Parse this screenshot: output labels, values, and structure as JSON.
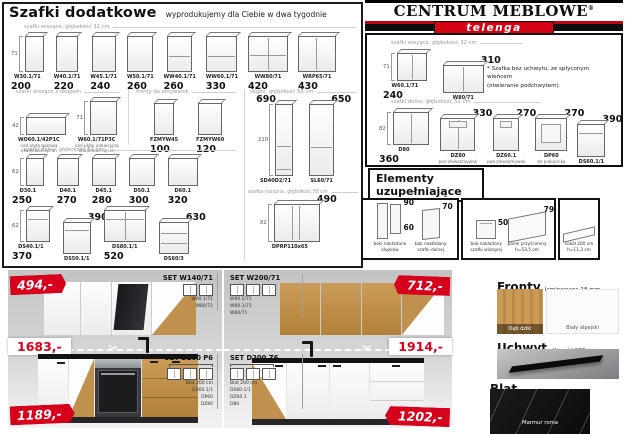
{
  "accent": {
    "red": "#d6001c",
    "wood": "#c0914e"
  },
  "header": {
    "title": "Szafki dodatkowe",
    "subtitle": "wyprodukujemy dla Ciebie w dwa tygodnie"
  },
  "logo": {
    "name": "CENTRUM MEBLOWE",
    "reg": "®",
    "sub": "telenga"
  },
  "catalog_left": {
    "row_wiszace": {
      "label": "szafki wiszące, głębokość 32 cm",
      "dim": "71",
      "items": [
        {
          "code": "W30.1/71",
          "price": "200",
          "pp": "bl"
        },
        {
          "code": "W40.1/71",
          "price": "220",
          "pp": "bl"
        },
        {
          "code": "W45.1/71",
          "price": "240",
          "pp": "bl"
        },
        {
          "code": "W50.1/71",
          "price": "260",
          "pp": "bl"
        },
        {
          "code": "WW40.1/71",
          "price": "260",
          "pp": "bl"
        },
        {
          "code": "WW60.1/71",
          "price": "330",
          "pp": "bl"
        },
        {
          "code": "WW80/71",
          "price": "420",
          "pp": "bl"
        },
        {
          "code": "WRP65/71",
          "price": "430",
          "pp": "bl"
        }
      ]
    },
    "row_okap": {
      "label": "szafki wiszące z okapem",
      "items": [
        {
          "code": "WO60.1/42P1C",
          "dim": "42",
          "sub": [
            "nad płytę gazową",
            "otwieranie tip-on"
          ]
        },
        {
          "code": "W60.1/71P3C",
          "dim": "71",
          "sub": [
            "nad płytę indukcyjną",
            "otwieranie tip-on"
          ]
        }
      ]
    },
    "row_fronty": {
      "label": "fronty do zmywarek",
      "items": [
        {
          "code": "FZMYW45",
          "price": "100",
          "pp": "bl"
        },
        {
          "code": "FZMYW60",
          "price": "120",
          "pp": "bl"
        }
      ]
    },
    "col_slupki": {
      "label": "słupki, głębokość 58 cm",
      "dim": "210",
      "items": [
        {
          "code": "SD40D2/71",
          "price": "690",
          "pp": "tl"
        },
        {
          "code": "SL60/71",
          "price": "650",
          "pp": "tr"
        }
      ]
    },
    "row_dolne_label": "szafki dolne, głębokość 51 cm",
    "row_dolneA": {
      "dim": "62",
      "items": [
        {
          "code": "D30.1",
          "price": "250",
          "pp": "bl"
        },
        {
          "code": "D40.1",
          "price": "270",
          "pp": "bl"
        },
        {
          "code": "D45.1",
          "price": "280",
          "pp": "bl"
        },
        {
          "code": "D50.1",
          "price": "300",
          "pp": "bl"
        },
        {
          "code": "D60.1",
          "price": "320",
          "pp": "bl"
        }
      ]
    },
    "row_dolneB": {
      "dim": "62",
      "items": [
        {
          "code": "DS40.1/1",
          "price": "370",
          "pp": "bl"
        },
        {
          "code": "DS50.1/1",
          "price": "390",
          "pp": "tr"
        },
        {
          "code": "DS80.1/1",
          "price": "520",
          "pp": "bl"
        },
        {
          "code": "DS60/3",
          "price": "630",
          "pp": "tr"
        }
      ]
    },
    "row_narozna": {
      "label": "szafka narożna, głębokość 58 cm",
      "dim": "82",
      "items": [
        {
          "code": "DPRP110x65",
          "price": "490",
          "pp": "tr"
        }
      ]
    }
  },
  "catalog_right": {
    "wiszace": {
      "label": "szafki wiszące, głębokość 32 cm",
      "dim": "71",
      "items": [
        {
          "code": "W60.1/71",
          "price": "240",
          "pp": "bl"
        },
        {
          "code": "W80/71",
          "price": "310",
          "pp": "tr"
        }
      ]
    },
    "note": "* Szafka bez uchwytu, ze spłyconym wieńcem\n(otwieranie podchwytem).",
    "dolne": {
      "label": "szafki dolne, głębokość 51 cm",
      "dim": "82",
      "items": [
        {
          "code": "D80",
          "price": "360",
          "pp": "bl"
        },
        {
          "code": "DZ80",
          "price": "330",
          "pp": "tr",
          "sub": [
            "pod zlewozmywak"
          ]
        },
        {
          "code": "DZ60.1",
          "price": "270",
          "pp": "tr",
          "sub": [
            "pod zlewozmywak"
          ]
        },
        {
          "code": "DP60",
          "price": "270",
          "pp": "tr",
          "sub": [
            "do piekarnika"
          ]
        },
        {
          "code": "DS60.1/1",
          "price": "390",
          "pp": "tr"
        }
      ]
    }
  },
  "elements": {
    "title": "Elementy\nuzupełniające",
    "box1": [
      {
        "label": "boki nakładane\nsłupków",
        "price_top": "90",
        "price_bottom": "60"
      },
      {
        "label": "bok nakładany\nszafki dolnej",
        "price": "70"
      }
    ],
    "box2": [
      {
        "label": "bok nakładany\nszafki wiszącej",
        "price": "50"
      },
      {
        "label": "panel przyścienny\nh=53,5 cm",
        "price": "79"
      }
    ],
    "box3": [
      {
        "label": "cokół 200 cm\nh=11,3 cm"
      }
    ]
  },
  "sets": {
    "photo1": {
      "badge_top": "494,-",
      "set_top": {
        "name": "SET W140/71",
        "components": [
          "W60.1/71",
          "W80/71"
        ]
      },
      "cut_price": "1683,-",
      "set_bottom": {
        "name": "SET D200 P6",
        "components": [
          "Blat 200 cm",
          "DS60.1/1",
          "DP60",
          "DZ80"
        ]
      },
      "badge_bottom": "1189,-"
    },
    "photo2": {
      "set_top": {
        "name": "SET W200/71",
        "components": [
          "W60.1/71",
          "W60.1/71",
          "W80/71"
        ]
      },
      "badge_top": "712,-",
      "cut_price": "1914,-",
      "set_bottom": {
        "name": "SET D200 Z6",
        "components": [
          "Blat 200 cm",
          "DS60.1/1",
          "DZ60.1",
          "D80"
        ]
      },
      "badge_bottom": "1202,-"
    }
  },
  "materials": {
    "fronty": {
      "title": "Fronty",
      "subtitle": "laminowane 18 mm",
      "swatch_wood": "Dąb dziki",
      "swatch_white": "Biały alpejski"
    },
    "uchwyt": {
      "title": "Uchwyt",
      "subtitle": "długość 200 mm"
    },
    "blat": {
      "title": "Blat",
      "subtitle": "grubość 3,8 cm",
      "swatch": "Marmur roma"
    }
  }
}
